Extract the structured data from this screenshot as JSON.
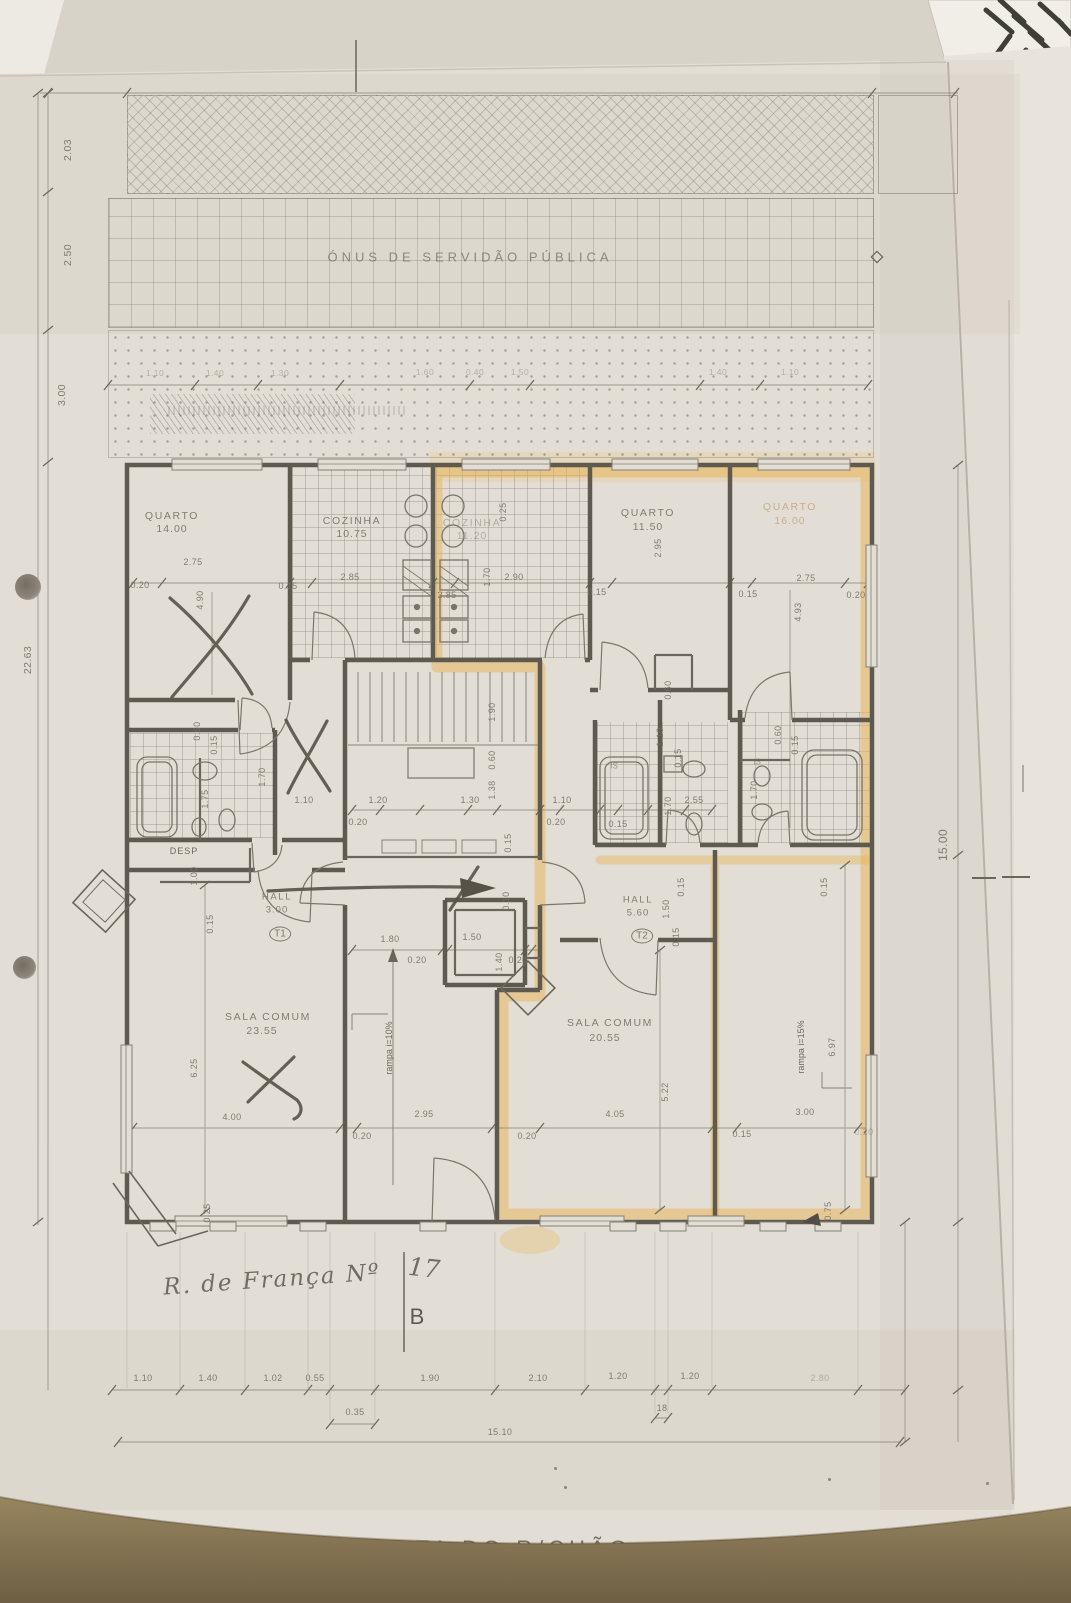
{
  "page": {
    "title": "PLANTA DO R/CHÃO",
    "servidao_band": "ÓNUS DE SERVIDÃO PÚBLICA",
    "hand_note": "R. de França Nº",
    "hand_number": "17",
    "section_letter": "B"
  },
  "units": {
    "t1": {
      "id": "T1",
      "hall_label": "HALL",
      "hall_area": "3.00"
    },
    "t2": {
      "id": "T2",
      "hall_label": "HALL",
      "hall_area": "5.60"
    }
  },
  "rooms": {
    "quarto_left": {
      "label": "QUARTO",
      "area": "14.00"
    },
    "cozinha_t1": {
      "label": "COZINHA",
      "area": "10.75"
    },
    "cozinha_t2": {
      "label": "COZINHA",
      "area": "11.20"
    },
    "quarto_mid": {
      "label": "QUARTO",
      "area": "11.50"
    },
    "quarto_right": {
      "label": "QUARTO",
      "area": "16.00"
    },
    "sala_t1": {
      "label": "SALA COMUM",
      "area": "23.55"
    },
    "sala_t2": {
      "label": "SALA COMUM",
      "area": "20.55"
    },
    "despensa": {
      "label": "DESP"
    },
    "is_a": {
      "label": "IS"
    },
    "is_b": {
      "label": "IS"
    },
    "ramp_t1": {
      "label": "rampa i=10%"
    },
    "ramp_t2": {
      "label": "rampa i=15%"
    }
  },
  "dims": {
    "left_col": [
      "2.03",
      "2.50",
      "3.00",
      "22.63"
    ],
    "right_col": [
      "15.00"
    ],
    "setback_row": [
      "1.10",
      "1.40",
      "1.30",
      "1.60",
      "0.40",
      "1.50",
      "1.40",
      "1.10"
    ],
    "room_row": [
      "0.20",
      "2.75",
      "4.90",
      "0.15",
      "2.85",
      "3.85",
      "1.70",
      "2.90",
      "0.25",
      "0.15",
      "2.95",
      "0.15",
      "2.75",
      "0.20",
      "4.93"
    ],
    "mid": [
      "1.90",
      "0.60",
      "1.38",
      "1.20",
      "1.30",
      "0.20",
      "0.15",
      "1.10",
      "0.20",
      "0.15",
      "0.60",
      "1.10",
      "0.15",
      "1.70",
      "2.55",
      "0.60",
      "0.15",
      "1.70",
      "1.00",
      "0.15",
      "0.60",
      "0.15",
      "1.70",
      "1.75",
      "1.10",
      "1.80",
      "0.20",
      "1.50",
      "1.40",
      "0.20",
      "0.10",
      "1.50",
      "0.15",
      "0.15",
      "0.15",
      "6.97",
      "5.22"
    ],
    "bottom_zone": [
      "6.25",
      "4.00",
      "0.20",
      "2.95",
      "0.20",
      "4.05",
      "3.00",
      "0.15",
      "0.20",
      "0.75",
      "0.25"
    ],
    "bottom_row": [
      "1.10",
      "1.40",
      "1.02",
      "0.55",
      "0.35",
      "1.90",
      "2.10",
      "1.20",
      "1.20",
      "18",
      "2.80"
    ],
    "total_width": "15.10"
  },
  "colors": {
    "highlight": "#e8b254",
    "pencil": "#5f5a50",
    "paper": "#e2ded5",
    "table": "#7c6c4f"
  }
}
